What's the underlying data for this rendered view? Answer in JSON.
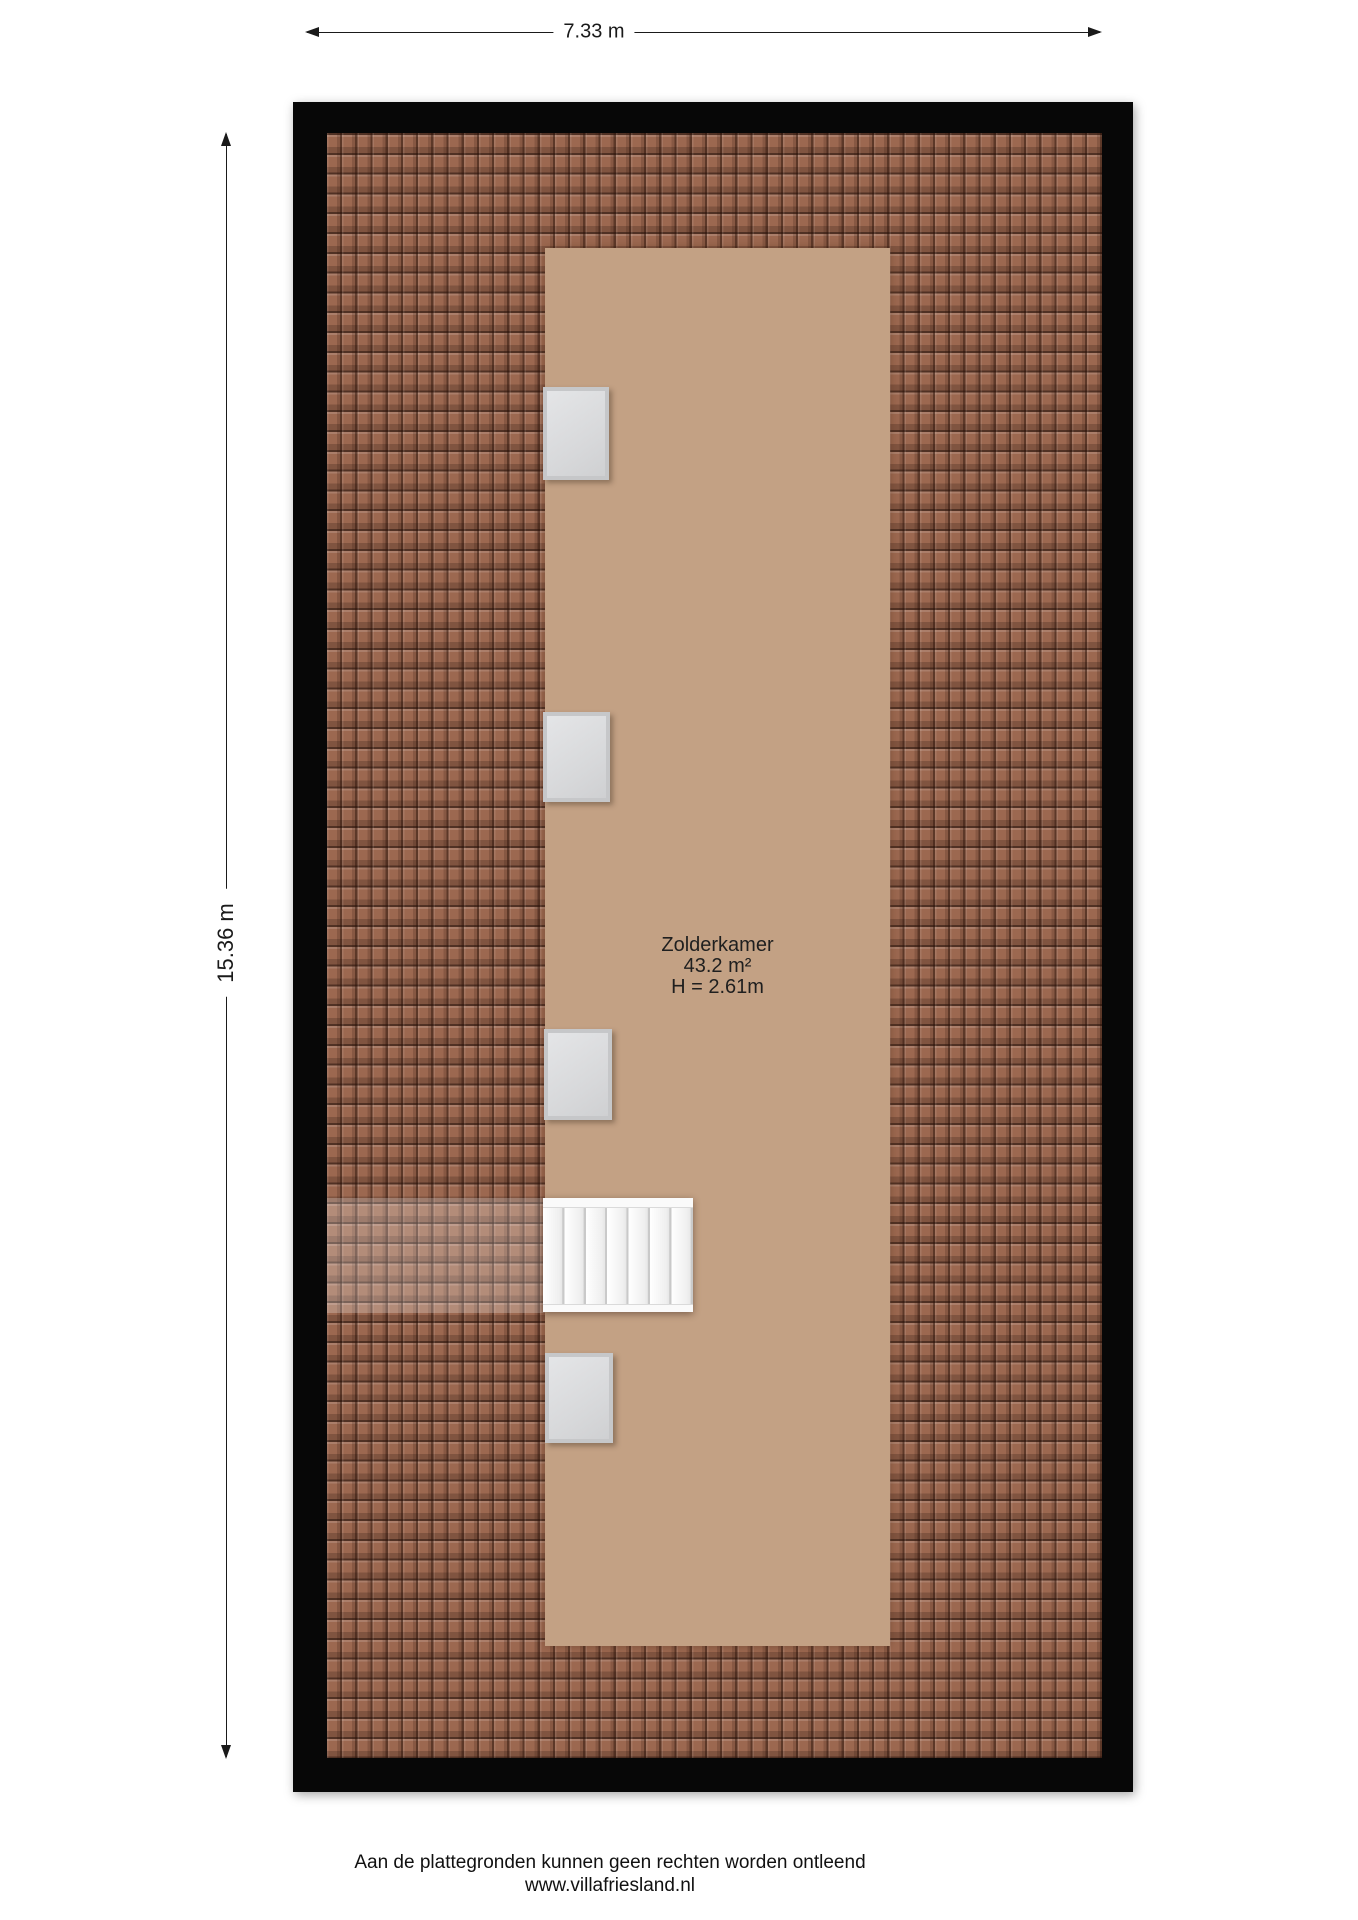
{
  "dimensions": {
    "width": "7.33 m",
    "height": "15.36 m"
  },
  "room": {
    "name": "Zolderkamer",
    "area": "43.2 m²",
    "ceiling_height": "H = 2.61m"
  },
  "footer": {
    "disclaimer": "Aan de plattegronden kunnen geen rechten worden ontleend",
    "website": "www.villafriesland.nl"
  },
  "elements": {
    "roof_window_count": 4,
    "stair_tread_count": 7,
    "icons": [
      "dimension-arrow-left",
      "dimension-arrow-right",
      "dimension-arrow-up",
      "dimension-arrow-down"
    ]
  },
  "colors": {
    "roof_base": "#9c6850",
    "floor": "#c3a184",
    "wall": "#070707",
    "window_frame": "#c6c7c9",
    "window_glass": "#dcdde0",
    "stair_face": "#fafafa",
    "stair_divider": "#c9c9c9",
    "line": "#1a1a1a",
    "text": "#1a1a1a"
  }
}
